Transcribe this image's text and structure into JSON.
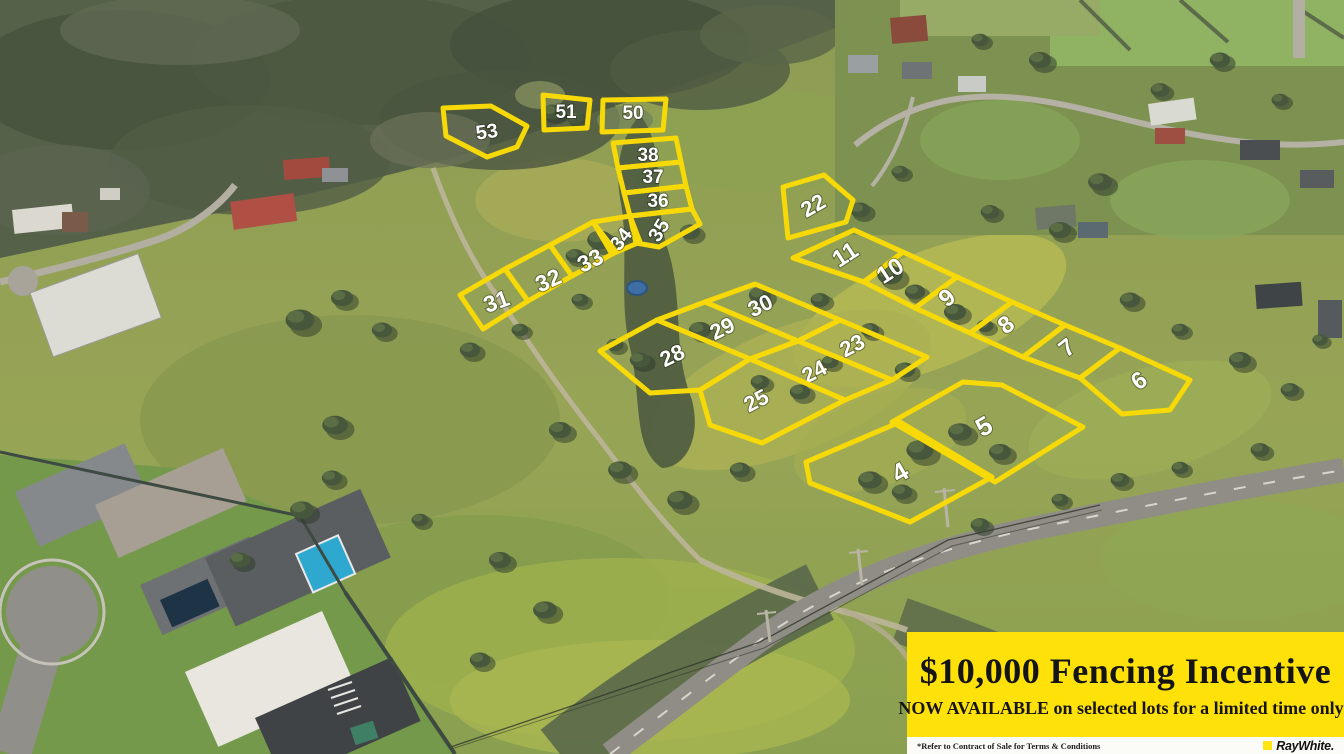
{
  "colors": {
    "lot_line": "#F7D908",
    "lot_label": "#FFFFFF",
    "banner_bg": "#FFE10A",
    "banner_text": "#141414",
    "strip_bg": "#FBFBF8",
    "raywhite_yellow": "#FFE512"
  },
  "banner": {
    "headline": "$10,000 Fencing Incentive",
    "subline": "NOW AVAILABLE on selected lots for a limited time only*",
    "fine_print": "*Refer to Contract of Sale for Terms & Conditions",
    "brand": "RayWhite."
  },
  "lots": [
    {
      "id": "53",
      "points": "443,108 491,106 527,126 517,147 487,157 446,136",
      "lx": 487,
      "ly": 133,
      "rot": -8,
      "size": 20
    },
    {
      "id": "51",
      "points": "543,95 590,100 587,128 544,130",
      "lx": 566,
      "ly": 113,
      "rot": 0,
      "size": 19
    },
    {
      "id": "50",
      "points": "603,100 666,99 663,130 602,132",
      "lx": 633,
      "ly": 114,
      "rot": 0,
      "size": 19
    },
    {
      "id": "38",
      "points": "613,143 676,138 681,162 618,168",
      "lx": 648,
      "ly": 156,
      "rot": 0,
      "size": 19
    },
    {
      "id": "37",
      "points": "618,168 681,162 686,186 624,193",
      "lx": 653,
      "ly": 178,
      "rot": 0,
      "size": 19
    },
    {
      "id": "36",
      "points": "624,193 686,186 692,209 630,216",
      "lx": 658,
      "ly": 202,
      "rot": 0,
      "size": 19
    },
    {
      "id": "35",
      "points": "630,216 692,209 700,224 659,247 636,243",
      "lx": 660,
      "ly": 231,
      "rot": -58,
      "size": 20
    },
    {
      "id": "34",
      "points": "593,222 630,216 640,242 612,254",
      "lx": 622,
      "ly": 240,
      "rot": -52,
      "size": 20
    },
    {
      "id": "33",
      "points": "550,245 593,222 616,252 572,276",
      "lx": 591,
      "ly": 262,
      "rot": -26,
      "size": 23
    },
    {
      "id": "32",
      "points": "505,269 550,245 572,276 528,301",
      "lx": 549,
      "ly": 282,
      "rot": -24,
      "size": 23
    },
    {
      "id": "31",
      "points": "460,295 505,269 528,301 483,329",
      "lx": 497,
      "ly": 303,
      "rot": -20,
      "size": 23
    },
    {
      "id": "22",
      "points": "783,187 824,175 853,200 846,222 788,238",
      "lx": 814,
      "ly": 207,
      "rot": -30,
      "size": 22
    },
    {
      "id": "11",
      "points": "793,258 854,230 903,252 864,282",
      "lx": 846,
      "ly": 256,
      "rot": -33,
      "size": 24
    },
    {
      "id": "10",
      "points": "903,252 957,277 915,308 864,282",
      "lx": 891,
      "ly": 272,
      "rot": -33,
      "size": 24
    },
    {
      "id": "9",
      "points": "957,277 1012,302 970,333 915,308",
      "lx": 948,
      "ly": 299,
      "rot": -40,
      "size": 24
    },
    {
      "id": "8",
      "points": "1012,302 1065,325 1023,357 970,333",
      "lx": 1007,
      "ly": 326,
      "rot": -38,
      "size": 24
    },
    {
      "id": "7",
      "points": "1065,325 1120,348 1080,378 1023,357",
      "lx": 1068,
      "ly": 349,
      "rot": -38,
      "size": 24
    },
    {
      "id": "6",
      "points": "1120,348 1190,380 1170,410 1122,414 1080,378",
      "lx": 1140,
      "ly": 382,
      "rot": -35,
      "size": 24
    },
    {
      "id": "30",
      "points": "705,302 755,284 840,320 798,341",
      "lx": 761,
      "ly": 307,
      "rot": -26,
      "size": 22
    },
    {
      "id": "29",
      "points": "657,320 705,302 798,341 750,359",
      "lx": 723,
      "ly": 330,
      "rot": -26,
      "size": 22
    },
    {
      "id": "28",
      "points": "600,351 657,320 750,359 700,390 650,393",
      "lx": 673,
      "ly": 357,
      "rot": -26,
      "size": 22
    },
    {
      "id": "23",
      "points": "798,341 840,320 927,357 892,380",
      "lx": 853,
      "ly": 347,
      "rot": -28,
      "size": 22
    },
    {
      "id": "24",
      "points": "750,359 798,341 892,380 845,400",
      "lx": 815,
      "ly": 373,
      "rot": -28,
      "size": 22
    },
    {
      "id": "25",
      "points": "700,390 750,359 845,400 762,443 710,425",
      "lx": 757,
      "ly": 402,
      "rot": -28,
      "size": 22
    },
    {
      "id": "5",
      "points": "892,422 963,382 1002,385 1083,427 995,482",
      "lx": 985,
      "ly": 428,
      "rot": -30,
      "size": 26
    },
    {
      "id": "4",
      "points": "806,462 900,422 992,477 910,522 810,483",
      "lx": 901,
      "ly": 474,
      "rot": -30,
      "size": 26
    }
  ]
}
